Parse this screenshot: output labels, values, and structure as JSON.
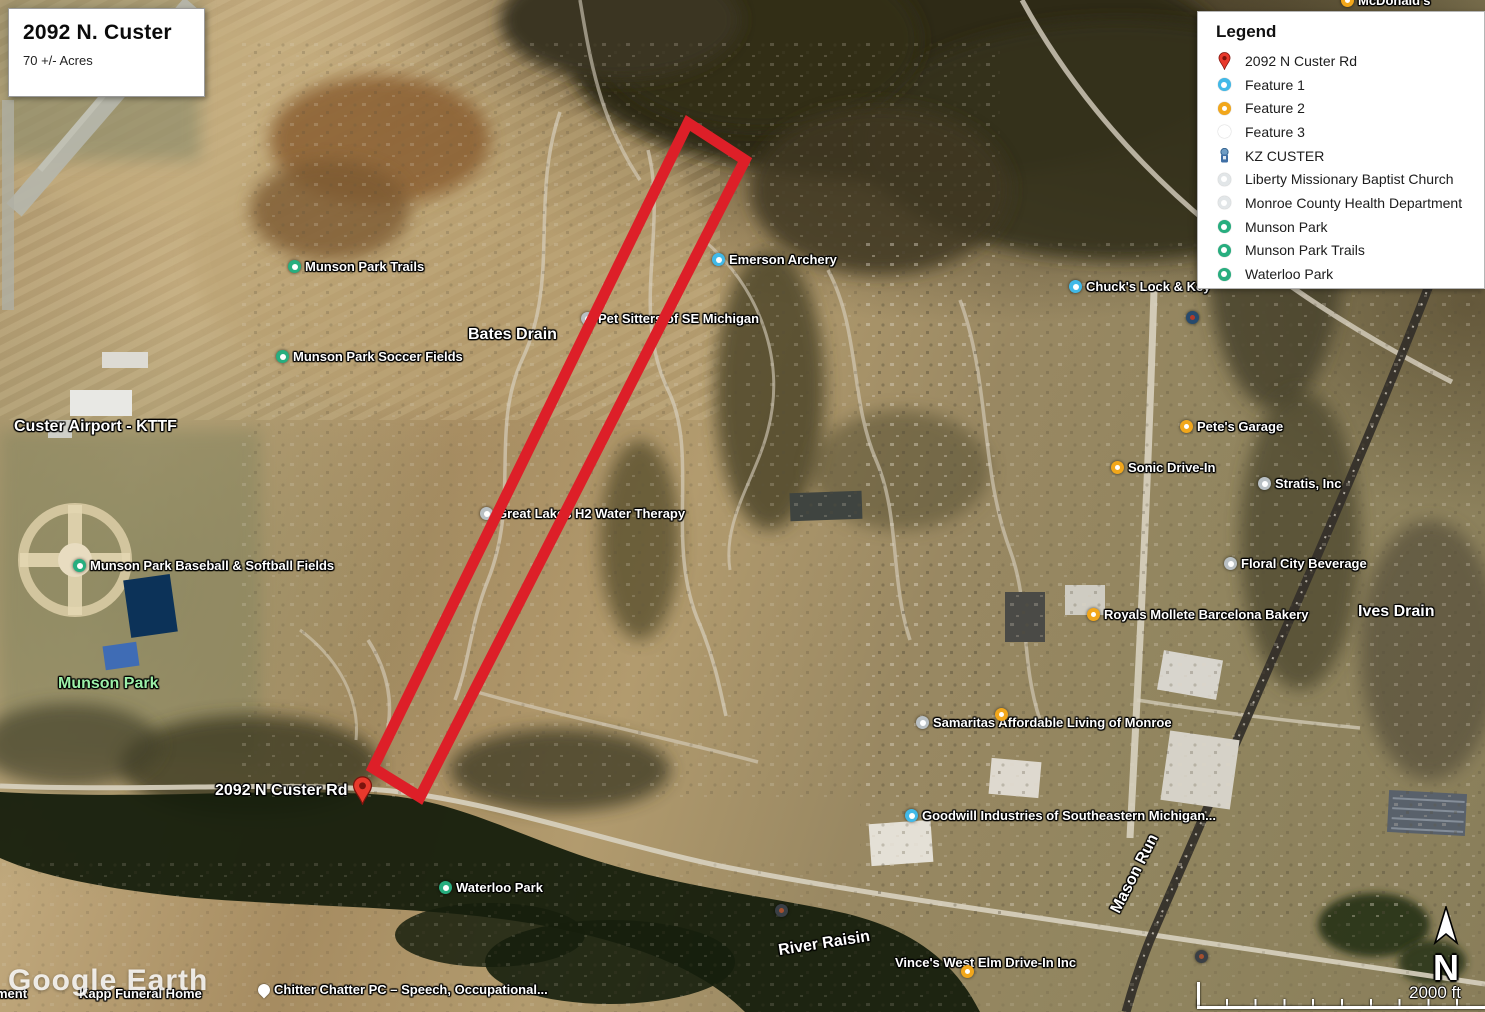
{
  "title_box": {
    "title": "2092 N. Custer",
    "subtitle": "70 +/- Acres"
  },
  "legend": {
    "title": "Legend",
    "items": [
      {
        "icon": "pin-red",
        "label": "2092 N Custer Rd"
      },
      {
        "icon": "cyan",
        "label": "Feature 1"
      },
      {
        "icon": "yellow",
        "label": "Feature 2"
      },
      {
        "icon": "gray",
        "label": "Feature 3"
      },
      {
        "icon": "kz",
        "label": "KZ CUSTER"
      },
      {
        "icon": "lgray",
        "label": "Liberty Missionary Baptist Church"
      },
      {
        "icon": "lgray",
        "label": "Monroe County Health Department"
      },
      {
        "icon": "green",
        "label": "Munson Park"
      },
      {
        "icon": "green",
        "label": "Munson Park Trails"
      },
      {
        "icon": "green",
        "label": "Waterloo Park"
      }
    ]
  },
  "map_labels": [
    {
      "label": "McDonald's",
      "x": 1341,
      "y": -6,
      "icon": "yellow"
    },
    {
      "label": "Munson Park Trails",
      "x": 288,
      "y": 260,
      "icon": "green"
    },
    {
      "label": "Chuck's Lock & Key",
      "x": 1069,
      "y": 280,
      "icon": "cyan"
    },
    {
      "label": "",
      "x": 1186,
      "y": 311,
      "icon": "kz"
    },
    {
      "label": "Pet Sitters of SE Michigan",
      "x": 581,
      "y": 312,
      "icon": "white"
    },
    {
      "label": "Bates Drain",
      "x": 468,
      "y": 327,
      "icon": "none",
      "size": "large"
    },
    {
      "label": "Munson Park Soccer Fields",
      "x": 276,
      "y": 350,
      "icon": "green"
    },
    {
      "label": "Emerson Archery",
      "x": 712,
      "y": 253,
      "icon": "cyan"
    },
    {
      "label": "Custer Airport - KTTF",
      "x": 14,
      "y": 419,
      "icon": "none",
      "size": "large"
    },
    {
      "label": "Pete's Garage",
      "x": 1180,
      "y": 420,
      "icon": "yellow"
    },
    {
      "label": "Sonic Drive-In",
      "x": 1111,
      "y": 461,
      "icon": "yellow"
    },
    {
      "label": "Stratis, Inc",
      "x": 1258,
      "y": 477,
      "icon": "white"
    },
    {
      "label": "Great Lakes H2 Water Therapy",
      "x": 480,
      "y": 507,
      "icon": "white"
    },
    {
      "label": "Floral City Beverage",
      "x": 1224,
      "y": 557,
      "icon": "white"
    },
    {
      "label": "Munson Park Baseball & Softball Fields",
      "x": 73,
      "y": 559,
      "icon": "green"
    },
    {
      "label": "Ives Drain",
      "x": 1358,
      "y": 604,
      "icon": "none",
      "size": "large"
    },
    {
      "label": "Royals Mollete Barcelona Bakery",
      "x": 1087,
      "y": 608,
      "icon": "yellow"
    },
    {
      "label": "Munson Park",
      "x": 58,
      "y": 676,
      "icon": "none",
      "size": "large",
      "color": "#9cf0a8"
    },
    {
      "label": "Samaritas Affordable Living of Monroe",
      "x": 916,
      "y": 716,
      "icon": "white"
    },
    {
      "label": "",
      "x": 995,
      "y": 708,
      "icon": "yellow"
    },
    {
      "label": "2092 N Custer Rd",
      "x": 215,
      "y": 776,
      "icon": "pin-red",
      "icon_side": "right",
      "size": "large",
      "top_layer": true
    },
    {
      "label": "Goodwill Industries of Southeastern Michigan...",
      "x": 905,
      "y": 809,
      "icon": "cyan"
    },
    {
      "label": "Mason Run",
      "x": 1092,
      "y": 866,
      "icon": "none",
      "size": "large",
      "rotate": -63
    },
    {
      "label": "",
      "x": 775,
      "y": 904,
      "icon": "dark"
    },
    {
      "label": "Waterloo Park",
      "x": 439,
      "y": 881,
      "icon": "green"
    },
    {
      "label": "River Raisin",
      "x": 778,
      "y": 936,
      "icon": "none",
      "size": "large",
      "rotate": -9
    },
    {
      "label": "",
      "x": 1195,
      "y": 950,
      "icon": "dark"
    },
    {
      "label": "Vince's West Elm Drive-In Inc",
      "x": 895,
      "y": 956,
      "icon": "none"
    },
    {
      "label": "",
      "x": 961,
      "y": 965,
      "icon": "yellow"
    },
    {
      "label": "ment",
      "x": -4,
      "y": 987,
      "icon": "none"
    },
    {
      "label": "Kapp Funeral Home",
      "x": 79,
      "y": 987,
      "icon": "none"
    },
    {
      "label": "Chitter Chatter PC – Speech, Occupational...",
      "x": 258,
      "y": 983,
      "icon": "pin-white"
    }
  ],
  "parcel_outline": {
    "color": "#dd1f28",
    "stroke_width": 11,
    "vertices": [
      [
        688,
        123
      ],
      [
        745,
        160
      ],
      [
        420,
        797
      ],
      [
        373,
        768
      ]
    ]
  },
  "scale_bar": {
    "label": "2000 ft"
  },
  "north_arrow": {
    "label": "N"
  },
  "watermark": {
    "label": "Google Earth"
  }
}
